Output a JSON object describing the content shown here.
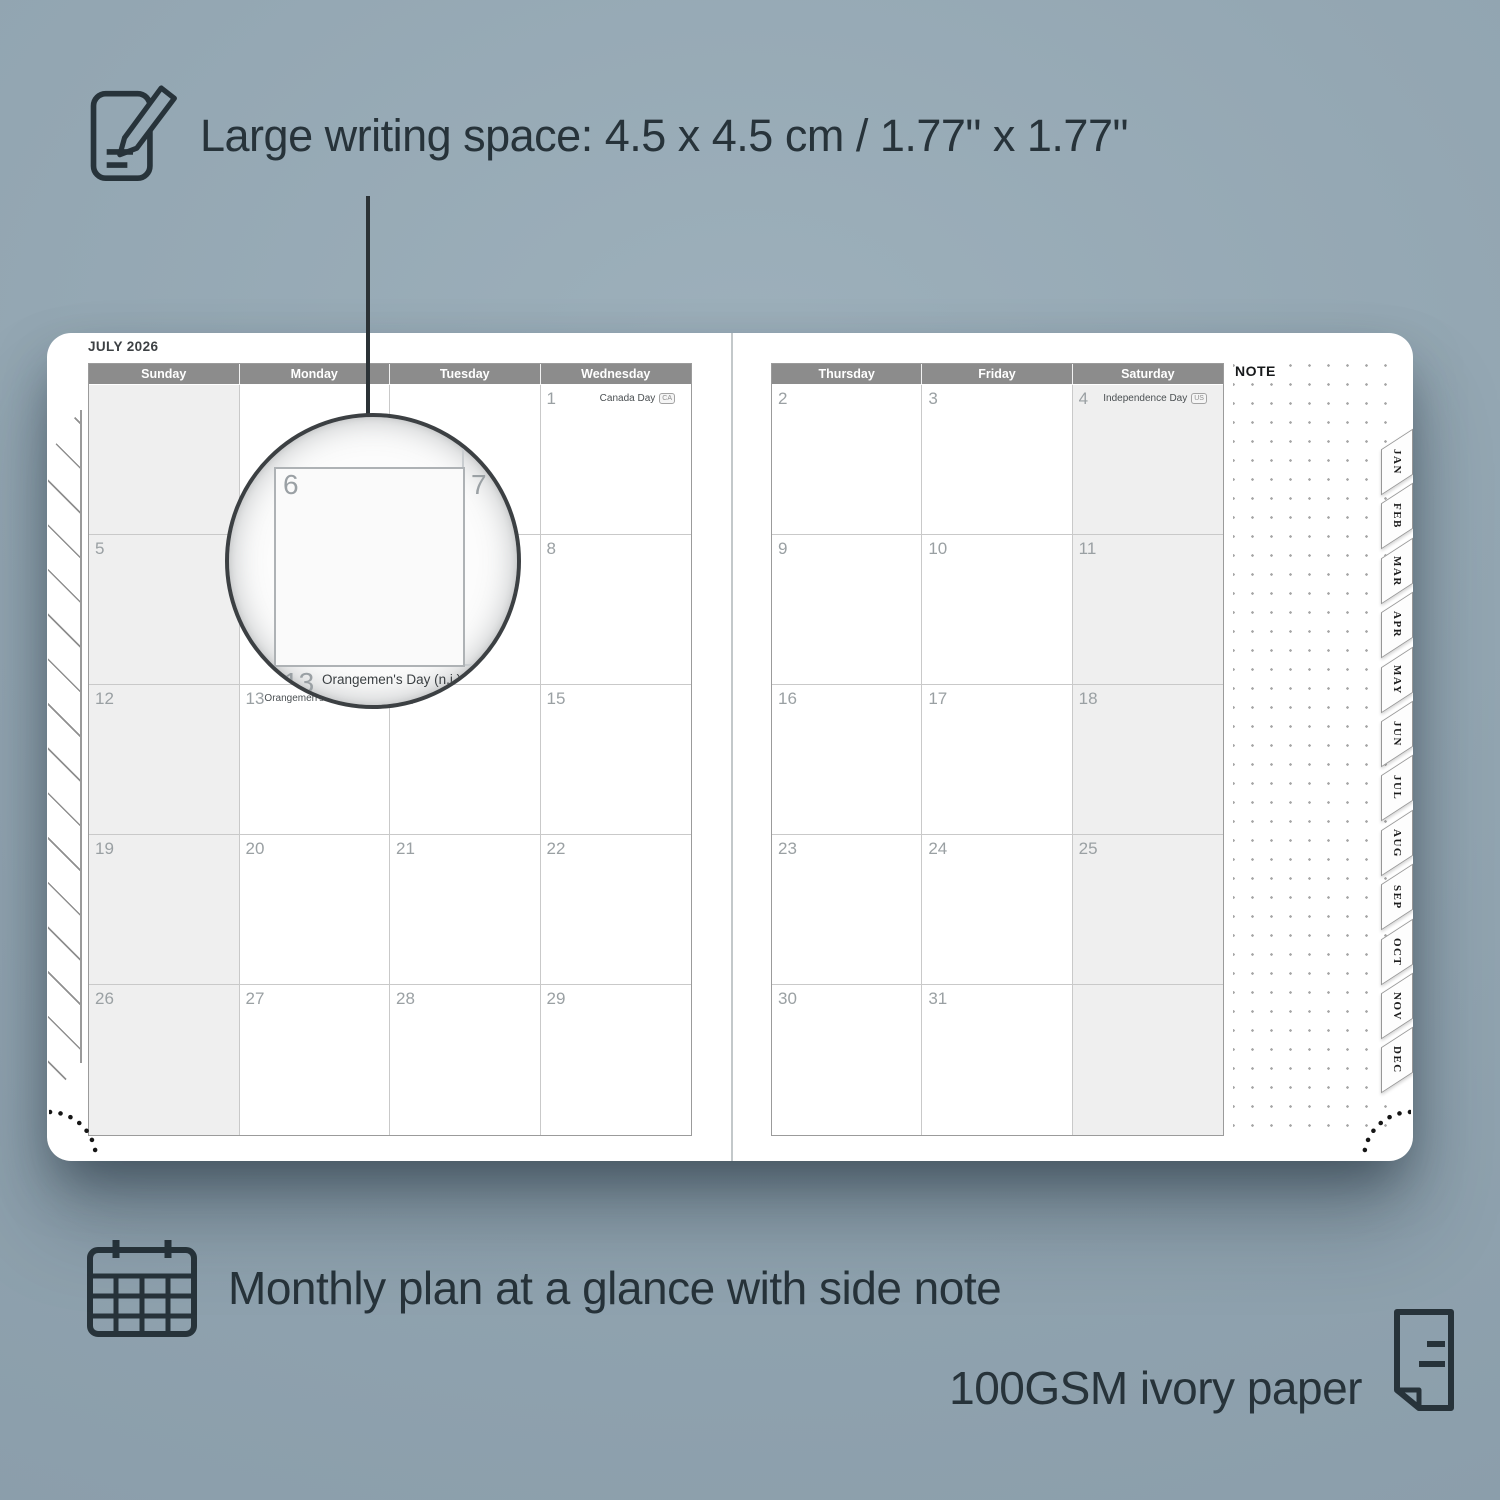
{
  "colors": {
    "background": "#94a7b3",
    "ink": "#27333a",
    "header_bar": "#8c8c8c",
    "shaded_cell": "#efefef",
    "date_number": "#9aa0a3",
    "page": "#ffffff"
  },
  "top_annotation": {
    "text": "Large writing space: 4.5 x 4.5 cm / 1.77\" x 1.77\""
  },
  "bottom_annotations": {
    "line1": "Monthly plan at a glance with side note",
    "line2": "100GSM ivory paper"
  },
  "planner": {
    "title": "JULY 2026",
    "note_label": "NOTE",
    "month_tabs": [
      "JAN",
      "FEB",
      "MAR",
      "APR",
      "MAY",
      "JUN",
      "JUL",
      "AUG",
      "SEP",
      "OCT",
      "NOV",
      "DEC"
    ],
    "left_page": {
      "day_headers": [
        "Sunday",
        "Monday",
        "Tuesday",
        "Wednesday"
      ],
      "shaded_day": "Sunday",
      "weeks": [
        [
          {
            "n": ""
          },
          {
            "n": ""
          },
          {
            "n": ""
          },
          {
            "n": "1",
            "h": "Canada Day",
            "b": "CA"
          }
        ],
        [
          {
            "n": "5"
          },
          {
            "n": "6"
          },
          {
            "n": "7"
          },
          {
            "n": "8"
          }
        ],
        [
          {
            "n": "12"
          },
          {
            "n": "13",
            "h": "Orangemen's Day (n.i.)",
            "b": "UK"
          },
          {
            "n": "14"
          },
          {
            "n": "15"
          }
        ],
        [
          {
            "n": "19"
          },
          {
            "n": "20"
          },
          {
            "n": "21"
          },
          {
            "n": "22"
          }
        ],
        [
          {
            "n": "26"
          },
          {
            "n": "27"
          },
          {
            "n": "28"
          },
          {
            "n": "29"
          }
        ]
      ]
    },
    "right_page": {
      "day_headers": [
        "Thursday",
        "Friday",
        "Saturday"
      ],
      "shaded_day": "Saturday",
      "weeks": [
        [
          {
            "n": "2"
          },
          {
            "n": "3"
          },
          {
            "n": "4",
            "h": "Independence Day",
            "b": "US"
          }
        ],
        [
          {
            "n": "9"
          },
          {
            "n": "10"
          },
          {
            "n": "11"
          }
        ],
        [
          {
            "n": "16"
          },
          {
            "n": "17"
          },
          {
            "n": "18"
          }
        ],
        [
          {
            "n": "23"
          },
          {
            "n": "24"
          },
          {
            "n": "25"
          }
        ],
        [
          {
            "n": "30"
          },
          {
            "n": "31"
          },
          {
            "n": ""
          }
        ]
      ]
    },
    "magnifier": {
      "date_left": "6",
      "date_right": "7",
      "date_below": "13",
      "holiday": "Orangemen's Day (n.i.)",
      "badge": "UK"
    }
  }
}
